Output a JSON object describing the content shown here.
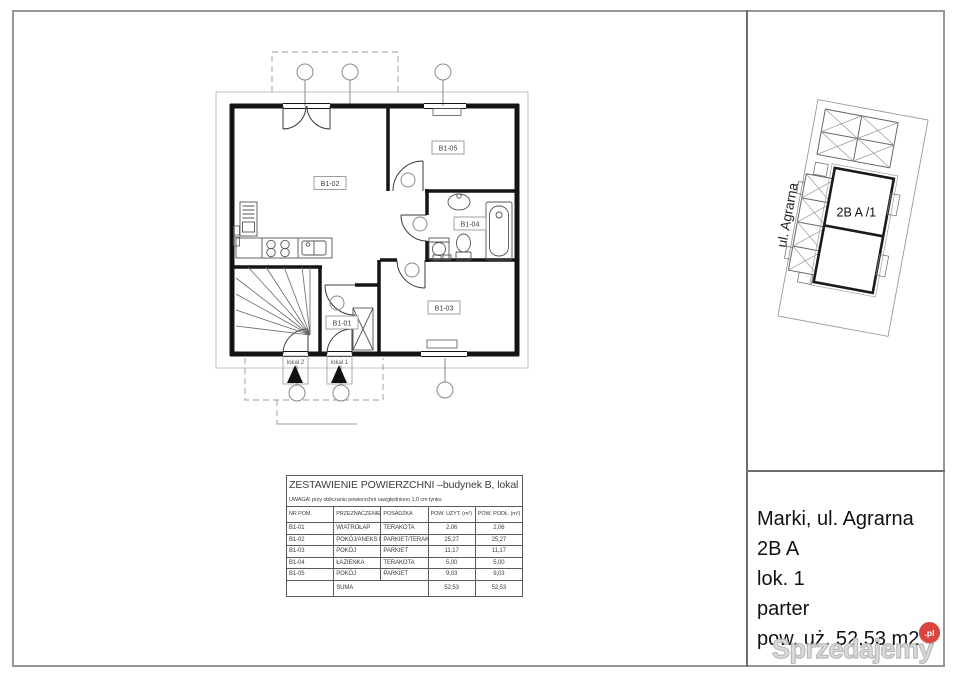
{
  "floor_plan": {
    "rooms": [
      {
        "id": "B1-01"
      },
      {
        "id": "B1-02"
      },
      {
        "id": "B1-03"
      },
      {
        "id": "B1-04"
      },
      {
        "id": "B1-05"
      }
    ],
    "entrances": [
      {
        "label": "lokal 2"
      },
      {
        "label": "lokal 1"
      }
    ]
  },
  "area_table": {
    "title": "ZESTAWIENIE POWIERZCHNI –budynek B, lokal 1",
    "note": "UWAGA! przy obliczaniu powierzchni uwzględniono 1,0 cm tynku",
    "columns": [
      "NR POM.",
      "PRZEZNACZENIE",
      "POSADZKA",
      "POW. UŻYT. (m²)",
      "POW. PODŁ. (m²)"
    ],
    "rows": [
      {
        "nr": "B1-01",
        "przeznaczenie": "WIATROŁAP",
        "posadzka": "TERAKOTA",
        "pow_uzyt": "2,06",
        "pow_podl": "2,06"
      },
      {
        "nr": "B1-02",
        "przeznaczenie": "POKÓJ/ANEKS KUCHENNY",
        "posadzka": "PARKIET/TERAKOTA",
        "pow_uzyt": "25,27",
        "pow_podl": "25,27"
      },
      {
        "nr": "B1-03",
        "przeznaczenie": "POKÓJ",
        "posadzka": "PARKIET",
        "pow_uzyt": "11,17",
        "pow_podl": "11,17"
      },
      {
        "nr": "B1-04",
        "przeznaczenie": "ŁAZIENKA",
        "posadzka": "TERAKOTA",
        "pow_uzyt": "5,00",
        "pow_podl": "5,00"
      },
      {
        "nr": "B1-05",
        "przeznaczenie": "POKÓJ",
        "posadzka": "PARKIET",
        "pow_uzyt": "9,03",
        "pow_podl": "9,03"
      }
    ],
    "sum": {
      "label": "SUMA",
      "pow_uzyt": "52,53",
      "pow_podl": "52,53"
    }
  },
  "site_plan": {
    "street": "ul. Agrarna",
    "unit": "2B A /1"
  },
  "address": {
    "line1": "Marki, ul. Agrarna 2B A",
    "line2": "lok. 1",
    "line3": "parter",
    "line4": "pow. uż. 52,53 m2"
  },
  "watermark": {
    "brand": "Sprzedajemy",
    "tld": ".pl",
    "badge_color": "#d9453f"
  }
}
